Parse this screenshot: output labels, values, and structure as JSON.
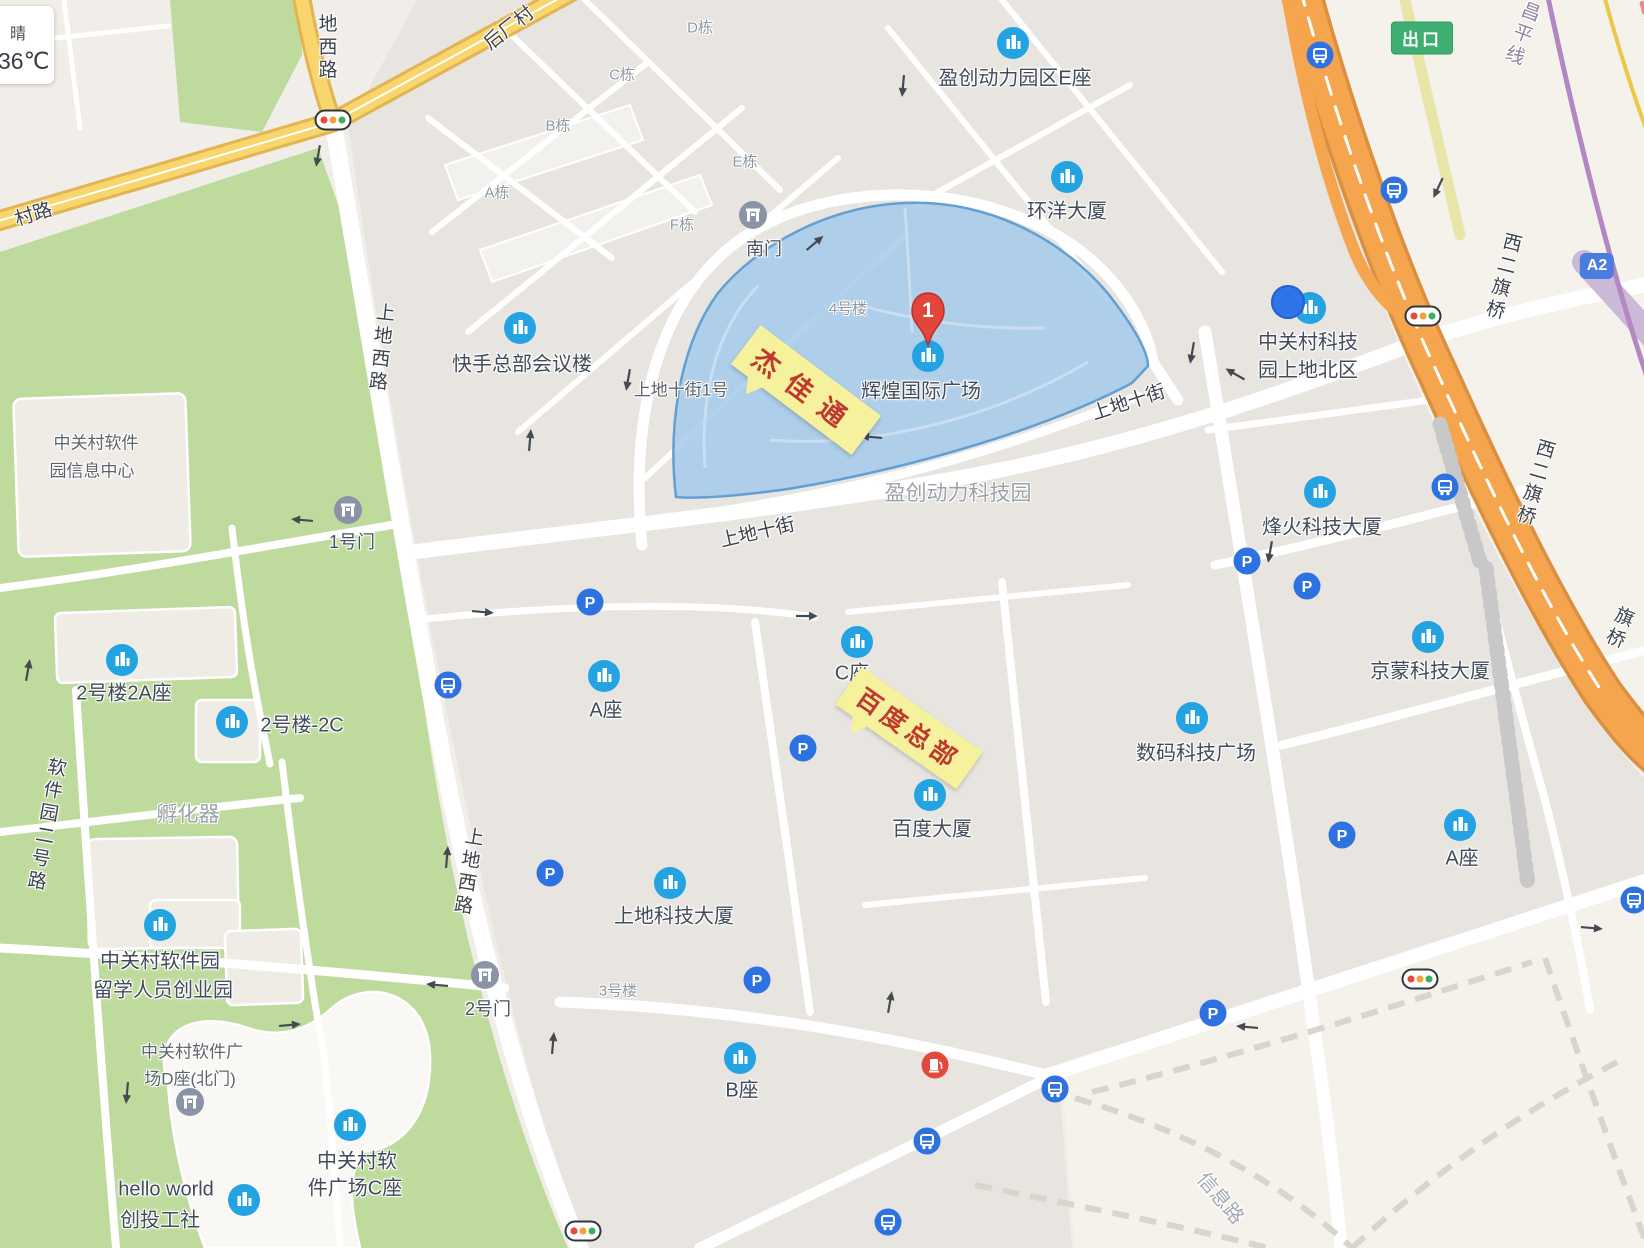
{
  "weather": {
    "condition": "晴",
    "temperature": "36℃"
  },
  "marker": {
    "label": "1",
    "x": 928,
    "y": 352
  },
  "location_dot": {
    "x": 1288,
    "y": 302
  },
  "badges": {
    "exit": {
      "text": "出口",
      "x": 1422,
      "y": 38
    },
    "a2": {
      "text": "A2",
      "x": 1597,
      "y": 266
    }
  },
  "callouts": [
    {
      "text": "杰佳通",
      "x": 806,
      "y": 390,
      "rot": 37,
      "font": 27,
      "spacing": 14
    },
    {
      "text": "百度总部",
      "x": 909,
      "y": 728,
      "rot": 35,
      "font": 25,
      "spacing": 5
    }
  ],
  "pois": [
    {
      "name": "盈创动力园区E座",
      "icon": {
        "x": 1013,
        "y": 43
      },
      "labels": [
        {
          "text": "盈创动力园区E座",
          "x": 1015,
          "y": 76
        }
      ]
    },
    {
      "name": "环洋大厦",
      "icon": {
        "x": 1067,
        "y": 177
      },
      "labels": [
        {
          "text": "环洋大厦",
          "x": 1067,
          "y": 209
        }
      ]
    },
    {
      "name": "快手总部会议楼",
      "icon": {
        "x": 520,
        "y": 328
      },
      "labels": [
        {
          "text": "快手总部会议楼",
          "x": 522,
          "y": 362
        }
      ]
    },
    {
      "name": "辉煌国际广场",
      "icon": {
        "x": 928,
        "y": 356
      },
      "labels": [
        {
          "text": "辉煌国际广场",
          "x": 921,
          "y": 389
        }
      ]
    },
    {
      "name": "中关村科技园上地北区",
      "icon": {
        "x": 1310,
        "y": 308
      },
      "labels": [
        {
          "text": "中关村科技",
          "x": 1308,
          "y": 340
        },
        {
          "text": "园上地北区",
          "x": 1308,
          "y": 368
        }
      ]
    },
    {
      "name": "烽火科技大厦",
      "icon": {
        "x": 1320,
        "y": 492
      },
      "labels": [
        {
          "text": "烽火科技大厦",
          "x": 1322,
          "y": 525
        }
      ]
    },
    {
      "name": "京蒙科技大厦",
      "icon": {
        "x": 1428,
        "y": 637
      },
      "labels": [
        {
          "text": "京蒙科技大厦",
          "x": 1430,
          "y": 669
        }
      ]
    },
    {
      "name": "A座-东",
      "icon": {
        "x": 1460,
        "y": 825
      },
      "labels": [
        {
          "text": "A座",
          "x": 1462,
          "y": 856
        }
      ]
    },
    {
      "name": "数码科技广场",
      "icon": {
        "x": 1192,
        "y": 718
      },
      "labels": [
        {
          "text": "数码科技广场",
          "x": 1196,
          "y": 751
        }
      ]
    },
    {
      "name": "C座",
      "icon": {
        "x": 857,
        "y": 642
      },
      "labels": [
        {
          "text": "C座",
          "x": 852,
          "y": 671
        }
      ]
    },
    {
      "name": "百度大厦",
      "icon": {
        "x": 930,
        "y": 795
      },
      "labels": [
        {
          "text": "百度大厦",
          "x": 932,
          "y": 827
        }
      ]
    },
    {
      "name": "A座-西",
      "icon": {
        "x": 604,
        "y": 676
      },
      "labels": [
        {
          "text": "A座",
          "x": 606,
          "y": 708
        }
      ]
    },
    {
      "name": "上地科技大厦",
      "icon": {
        "x": 670,
        "y": 883
      },
      "labels": [
        {
          "text": "上地科技大厦",
          "x": 674,
          "y": 914
        }
      ]
    },
    {
      "name": "B座",
      "icon": {
        "x": 740,
        "y": 1058
      },
      "labels": [
        {
          "text": "B座",
          "x": 742,
          "y": 1088
        }
      ]
    },
    {
      "name": "2号楼2A座",
      "icon": {
        "x": 122,
        "y": 660
      },
      "labels": [
        {
          "text": "2号楼2A座",
          "x": 124,
          "y": 691
        }
      ]
    },
    {
      "name": "2号楼-2C",
      "icon": {
        "x": 232,
        "y": 722
      },
      "labels": [
        {
          "text": "2号楼-2C",
          "x": 302,
          "y": 723
        }
      ]
    },
    {
      "name": "中关村软件园留学人员创业园",
      "icon": {
        "x": 160,
        "y": 925
      },
      "labels": [
        {
          "text": "中关村软件园",
          "x": 160,
          "y": 959
        },
        {
          "text": "留学人员创业园",
          "x": 163,
          "y": 988
        }
      ]
    },
    {
      "name": "hello world 创投工社",
      "icon": {
        "x": 244,
        "y": 1200
      },
      "labels": [
        {
          "text": "hello world",
          "x": 166,
          "y": 1190
        },
        {
          "text": "创投工社",
          "x": 160,
          "y": 1218
        }
      ]
    },
    {
      "name": "中关村软件广场C座",
      "icon": {
        "x": 350,
        "y": 1125
      },
      "labels": [
        {
          "text": "中关村软",
          "x": 357,
          "y": 1159
        },
        {
          "text": "件广场C座",
          "x": 355,
          "y": 1186
        }
      ]
    }
  ],
  "gates": [
    {
      "name": "南门",
      "icon": {
        "x": 753,
        "y": 215
      },
      "labels": [
        {
          "text": "南门",
          "x": 764,
          "y": 248
        }
      ]
    },
    {
      "name": "1号门",
      "icon": {
        "x": 348,
        "y": 510
      },
      "labels": [
        {
          "text": "1号门",
          "x": 352,
          "y": 541
        }
      ]
    },
    {
      "name": "2号门",
      "icon": {
        "x": 485,
        "y": 975
      },
      "labels": [
        {
          "text": "2号门",
          "x": 488,
          "y": 1008
        }
      ]
    },
    {
      "name": "D座北门",
      "icon": {
        "x": 190,
        "y": 1102
      },
      "labels": []
    }
  ],
  "addr_labels": [
    {
      "text": "上地十街1号",
      "x": 681,
      "y": 388
    },
    {
      "text": "中关村软件",
      "x": 96,
      "y": 441
    },
    {
      "text": "园信息中心",
      "x": 92,
      "y": 469
    },
    {
      "text": "中关村软件广",
      "x": 192,
      "y": 1050
    },
    {
      "text": "场D座(北门)",
      "x": 190,
      "y": 1077
    }
  ],
  "area_labels": [
    {
      "text": "盈创动力科技园",
      "x": 958,
      "y": 492,
      "size": "lg"
    },
    {
      "text": "孵化器",
      "x": 188,
      "y": 813,
      "size": "lg"
    },
    {
      "text": "4号楼",
      "x": 848,
      "y": 308,
      "size": "sm"
    },
    {
      "text": "3号楼",
      "x": 618,
      "y": 990,
      "size": "sm"
    },
    {
      "text": "A栋",
      "x": 497,
      "y": 192,
      "size": "sm"
    },
    {
      "text": "B栋",
      "x": 558,
      "y": 125,
      "size": "sm"
    },
    {
      "text": "C栋",
      "x": 622,
      "y": 74,
      "size": "sm"
    },
    {
      "text": "D栋",
      "x": 700,
      "y": 27,
      "size": "sm"
    },
    {
      "text": "E栋",
      "x": 745,
      "y": 161,
      "size": "sm"
    },
    {
      "text": "F栋",
      "x": 682,
      "y": 224,
      "size": "sm"
    }
  ],
  "road_labels": [
    {
      "text": "地西路",
      "x": 326,
      "y": 48,
      "vertical": true,
      "rot": 0
    },
    {
      "text": "上地西路",
      "x": 380,
      "y": 348,
      "vertical": true,
      "rot": 6
    },
    {
      "text": "上地西路",
      "x": 467,
      "y": 872,
      "vertical": true,
      "rot": 9
    },
    {
      "text": "村路",
      "x": 33,
      "y": 213,
      "rot": -17
    },
    {
      "text": "后厂村",
      "x": 508,
      "y": 27,
      "rot": -38
    },
    {
      "text": "上地十街",
      "x": 757,
      "y": 531,
      "rot": -13
    },
    {
      "text": "上地十街",
      "x": 1128,
      "y": 401,
      "rot": -18
    },
    {
      "text": "软件园二号路",
      "x": 45,
      "y": 825,
      "vertical": true,
      "rot": 10
    },
    {
      "text": "西二旗桥",
      "x": 1502,
      "y": 277,
      "vertical": true,
      "rot": 14
    },
    {
      "text": "西二旗桥",
      "x": 1534,
      "y": 483,
      "vertical": true,
      "rot": 16
    },
    {
      "text": "旗桥",
      "x": 1618,
      "y": 628,
      "vertical": true,
      "rot": 22
    },
    {
      "text": "昌平线",
      "x": 1521,
      "y": 34,
      "vertical": true,
      "rot": 20,
      "cls": "rail"
    },
    {
      "text": "信息路",
      "x": 1222,
      "y": 1197,
      "rot": 50,
      "cls": "area-road"
    }
  ],
  "parking_icons": [
    [
      590,
      602
    ],
    [
      803,
      748
    ],
    [
      550,
      873
    ],
    [
      757,
      980
    ],
    [
      1247,
      561
    ],
    [
      1307,
      586
    ],
    [
      1342,
      835
    ],
    [
      1213,
      1013
    ]
  ],
  "bus_stops": [
    [
      1320,
      55
    ],
    [
      1394,
      190
    ],
    [
      1445,
      487
    ],
    [
      448,
      685
    ],
    [
      927,
      1141
    ],
    [
      1055,
      1089
    ],
    [
      1634,
      900
    ],
    [
      888,
      1222
    ]
  ],
  "traffic_lights": [
    [
      333,
      120
    ],
    [
      1423,
      316
    ],
    [
      1420,
      979
    ],
    [
      583,
      1231
    ]
  ],
  "gas_stations": [
    [
      935,
      1065
    ]
  ],
  "arrows": [
    [
      318,
      156,
      100
    ],
    [
      903,
      86,
      95
    ],
    [
      815,
      243,
      -40
    ],
    [
      871,
      437,
      185
    ],
    [
      628,
      380,
      100
    ],
    [
      1192,
      353,
      100
    ],
    [
      1235,
      374,
      210
    ],
    [
      530,
      440,
      -85
    ],
    [
      483,
      612,
      5
    ],
    [
      807,
      616,
      0
    ],
    [
      302,
      520,
      185
    ],
    [
      28,
      670,
      -80
    ],
    [
      290,
      1025,
      -5
    ],
    [
      127,
      1093,
      95
    ],
    [
      447,
      857,
      -85
    ],
    [
      437,
      985,
      185
    ],
    [
      553,
      1043,
      -85
    ],
    [
      890,
      1002,
      -80
    ],
    [
      1247,
      1027,
      185
    ],
    [
      1592,
      928,
      5
    ],
    [
      1438,
      188,
      115
    ],
    [
      1270,
      552,
      100
    ]
  ],
  "colors": {
    "green": "#bedb9d",
    "block": "#e8e5e0",
    "base": "#f1eee9",
    "beige": "#f5f2ec",
    "highlight_fill": "#a6cbe9",
    "highlight_stroke": "#62a0d4",
    "yellow_road": "#f8d66d",
    "highway_orange": "#f4a54e",
    "subway_purple": "#b388c2",
    "poi_icon_blue": "#24a3e3",
    "transit_blue": "#2d72e0",
    "marker_red": "#e2453a",
    "callout_yellow": "#f5f19c",
    "callout_text_red": "#c0392e"
  }
}
